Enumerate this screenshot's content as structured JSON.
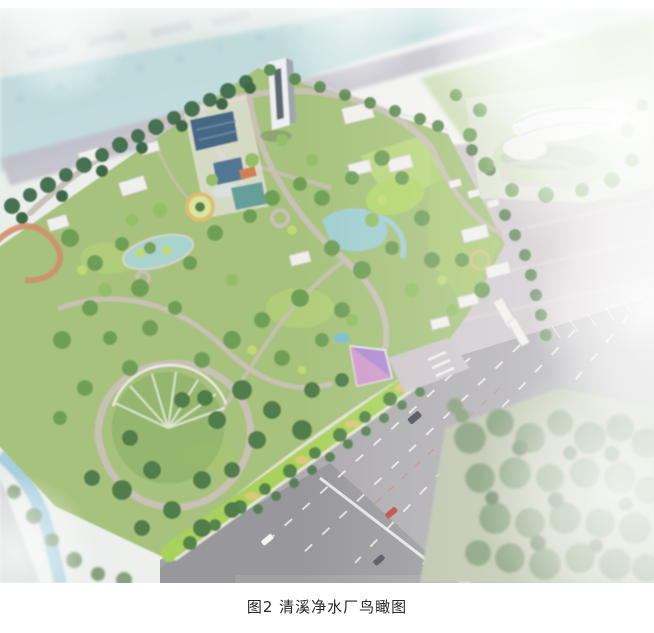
{
  "page": {
    "background": "#ffffff"
  },
  "figure": {
    "caption": "图2 清溪净水厂鸟瞰图",
    "alt": "清溪净水厂鸟瞰图",
    "palette": {
      "haze": "#f3f4f2",
      "river": "#b7d7da",
      "park-green": "#a2bf75",
      "tree-dark": "#3e6a49",
      "pool-blue": "#3e5f7f",
      "pond-teal": "#a6d2d2",
      "path-gray": "#c6beb2",
      "road-gray": "#a9a7ab",
      "parking-pink": "#cdc6ca",
      "canopy-purple": "#ab86cf",
      "building-white": "#f2f2f0",
      "berm-green": "#a5d054"
    }
  }
}
